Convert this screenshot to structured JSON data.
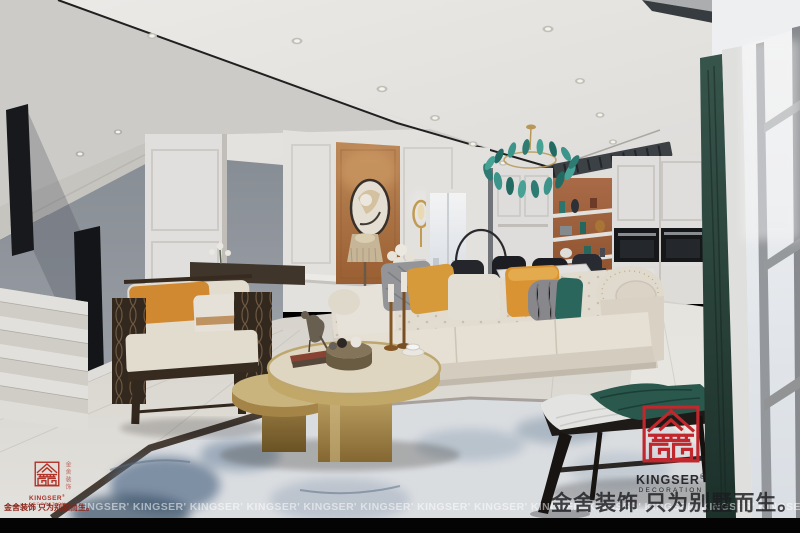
{
  "watermarks": {
    "slogan": "金舍装饰 只为别墅而生。",
    "vertical_tagline": "金舍装饰",
    "repeat_text": "KINGSER' KINGSER' KINGSER' KINGSER' KINGSER' KINGSER' KINGSER' KINGSER' KINGSER' KINGSER' KINGSER' KINGSER' KINGSER' KINGSER' KINGSER' KINGSER' KINGSER' KINGSER'",
    "logo": {
      "brand": "KINGSER",
      "reg_mark": "®",
      "subtitle": "DECORATION"
    }
  },
  "scene": {
    "setting": "modern cream-and-terracotta living room with staircase, open kitchen shelving, dining corner and floor-to-ceiling windows",
    "objects": [
      "recessed ceiling downlights",
      "teal glass-leaf chandelier",
      "ceiling air vent",
      "staircase with smoked glass balustrade and marble steps",
      "round mirror on terracotta wall panel",
      "gold wall sconce",
      "fringe table lamp",
      "cream tufted chesterfield sofa",
      "accent pillows (white, orange, grey knit, teal)",
      "dark wood lattice armchair with orange pillow",
      "round gold two-tier coffee table",
      "bird sculpture on books",
      "brass candlesticks",
      "blue abstract area rug",
      "dark curved bench with teal and white throws",
      "white kitchen cabinets with built-in black ovens",
      "terracotta open shelves with vases",
      "dining table with dark chairs",
      "ring floor lamp",
      "glossy marble floor",
      "floor-to-ceiling window wall with dark green curtain"
    ],
    "palette": {
      "logo_red": "#c1272d",
      "accent_orange": "#b97a4a",
      "shelf_terracotta": "#a96a40",
      "teal": "#2d6b60",
      "curtain_green": "#2c453d",
      "gold": "#c2a86b",
      "sofa_cream": "#e9e2d5",
      "wall_gray": "#9aa0a7",
      "floor_marble": "#e7e4de",
      "rug_blue": "#7a8fa8",
      "wood_dark": "#362a20",
      "bottom_bar": "#000000"
    }
  }
}
